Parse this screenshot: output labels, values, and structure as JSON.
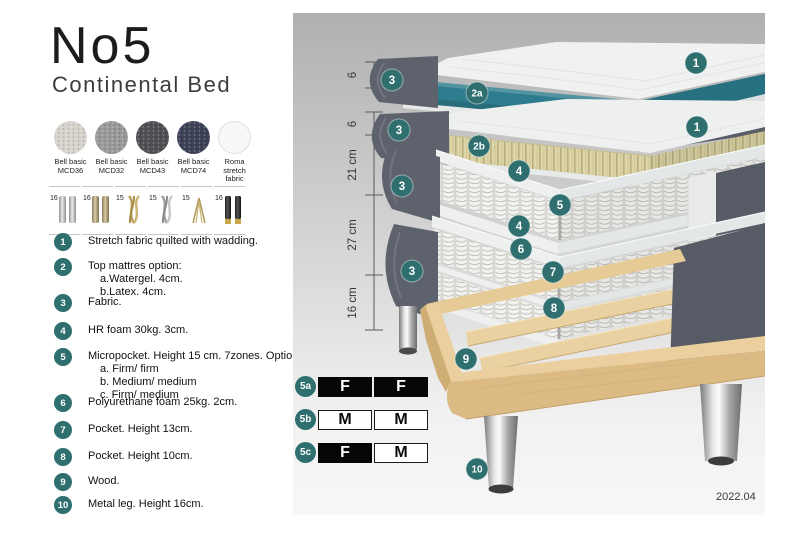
{
  "header": {
    "title": "No5",
    "subtitle": "Continental Bed"
  },
  "fabrics": [
    {
      "line1": "Bell basic",
      "line2": "MCD36",
      "color": "#d6d3cd"
    },
    {
      "line1": "Bell basic",
      "line2": "MCD32",
      "color": "#989a9c"
    },
    {
      "line1": "Bell basic",
      "line2": "MCD43",
      "color": "#4f5154"
    },
    {
      "line1": "Bell basic",
      "line2": "MCD74",
      "color": "#3d4257"
    },
    {
      "line1": "Roma",
      "line2": "stretch fabric",
      "color": "#f8f8f8"
    }
  ],
  "leg_options": [
    {
      "height": "16",
      "style": "silver-cylinder-leg"
    },
    {
      "height": "16",
      "style": "bronze-cylinder-leg"
    },
    {
      "height": "15",
      "style": "gold-twisted-leg"
    },
    {
      "height": "15",
      "style": "silver-twisted-leg"
    },
    {
      "height": "15",
      "style": "hairpin-leg"
    },
    {
      "height": "16",
      "style": "black-gold-tip-leg"
    }
  ],
  "legend": [
    {
      "num": "1",
      "text": "Stretch fabric quilted with wadding.",
      "subs": []
    },
    {
      "num": "2",
      "text": "Top mattres option:",
      "subs": [
        "a.Watergel. 4cm.",
        "b.Latex. 4cm."
      ]
    },
    {
      "num": "3",
      "text": "Fabric.",
      "subs": []
    },
    {
      "num": "4",
      "text": "HR foam 30kg. 3cm.",
      "subs": []
    },
    {
      "num": "5",
      "text": "Micropocket. Height 15 cm. 7zones. Option:",
      "subs": [
        "a. Firm/ firm",
        "b. Medium/ medium",
        "c. Firm/ medium"
      ]
    },
    {
      "num": "6",
      "text": "Polyurethane foam 25kg. 2cm.",
      "subs": []
    },
    {
      "num": "7",
      "text": "Pocket. Height 13cm.",
      "subs": []
    },
    {
      "num": "8",
      "text": "Pocket. Height 10cm.",
      "subs": []
    },
    {
      "num": "9",
      "text": "Wood.",
      "subs": []
    },
    {
      "num": "10",
      "text": "Metal leg. Height 16cm.",
      "subs": []
    }
  ],
  "firmness": [
    {
      "label": "5a",
      "cells": [
        {
          "text": "F",
          "variant": "dark"
        },
        {
          "text": "F",
          "variant": "dark"
        }
      ]
    },
    {
      "label": "5b",
      "cells": [
        {
          "text": "M",
          "variant": "light"
        },
        {
          "text": "M",
          "variant": "light"
        }
      ]
    },
    {
      "label": "5c",
      "cells": [
        {
          "text": "F",
          "variant": "dark"
        },
        {
          "text": "M",
          "variant": "light"
        }
      ]
    }
  ],
  "diagram": {
    "measurements": [
      {
        "label": "6"
      },
      {
        "label": "6"
      },
      {
        "label": "21 cm"
      },
      {
        "label": "27 cm"
      },
      {
        "label": "16 cm"
      }
    ],
    "callouts": [
      {
        "text": "3"
      },
      {
        "text": "2a"
      },
      {
        "text": "1"
      },
      {
        "text": "3"
      },
      {
        "text": "2b"
      },
      {
        "text": "1"
      },
      {
        "text": "4"
      },
      {
        "text": "5"
      },
      {
        "text": "4"
      },
      {
        "text": "3"
      },
      {
        "text": "6"
      },
      {
        "text": "7"
      },
      {
        "text": "8"
      },
      {
        "text": "3"
      },
      {
        "text": "9"
      },
      {
        "text": "10"
      }
    ],
    "date": "2022.04"
  },
  "colors": {
    "accent_teal": "#2f6f6f",
    "core_teal": "#2e7d8e",
    "latex_cream": "#ddd5a8",
    "fabric_gray": "#5d626c",
    "wood": "#eccf9e"
  }
}
